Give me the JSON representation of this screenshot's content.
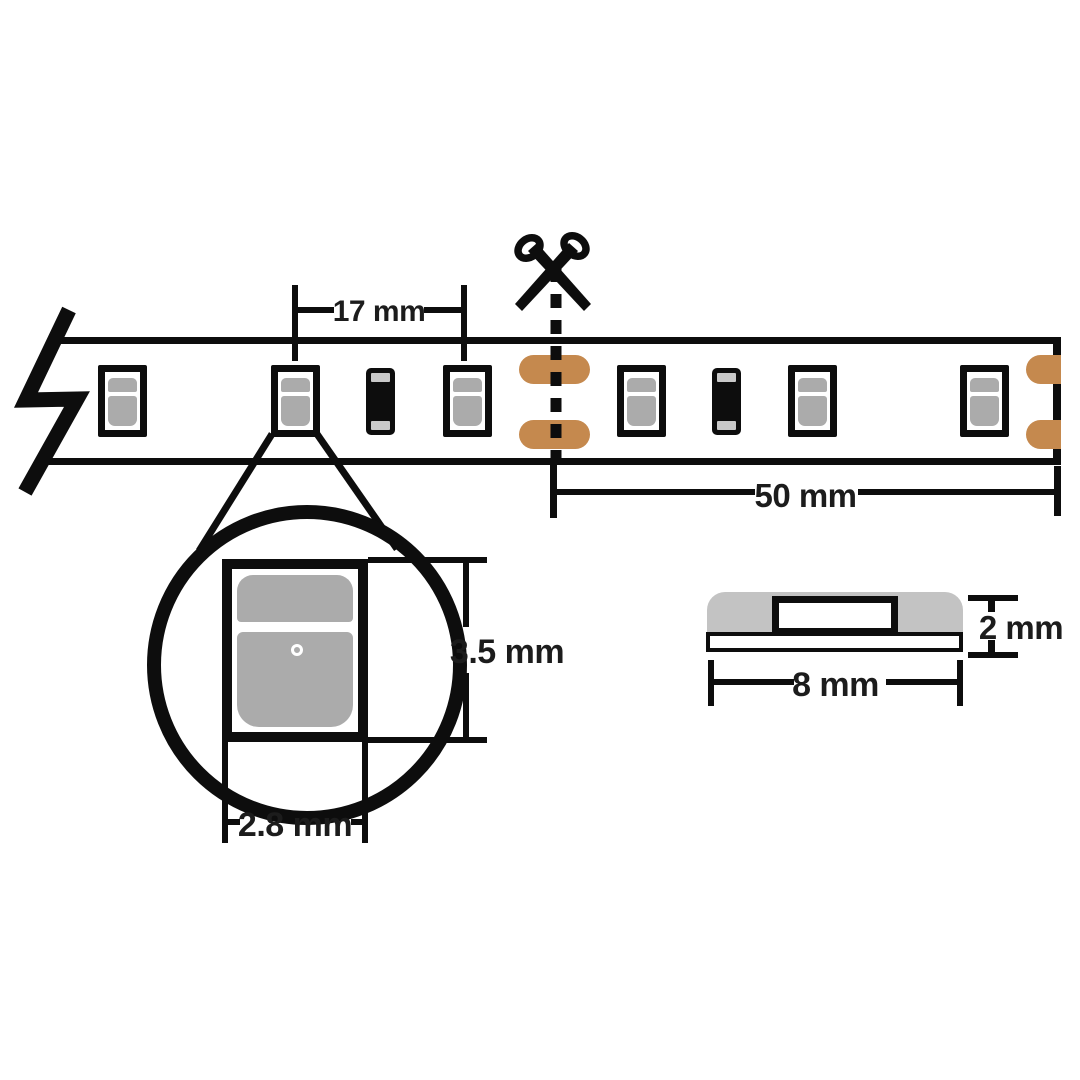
{
  "title": "LED strip cut-length and component dimensions diagram",
  "colors": {
    "line": "#0d0d0d",
    "text": "#1c1c1c",
    "led_gray": "#ababab",
    "terminal_gray": "#c9c9c9",
    "pad_copper": "#c5894e",
    "profile_gray": "#c3c3c3"
  },
  "dimensions": {
    "led_pitch": "17 mm",
    "cut_length": "50 mm",
    "led_height": "3.5 mm",
    "led_width": "2.8 mm",
    "strip_width": "8 mm",
    "strip_thickness": "2 mm"
  },
  "strip": {
    "components": [
      {
        "type": "led",
        "x": 98
      },
      {
        "type": "led",
        "x": 271
      },
      {
        "type": "resistor",
        "x": 366
      },
      {
        "type": "led",
        "x": 443
      },
      {
        "type": "pads",
        "x": 519
      },
      {
        "type": "led",
        "x": 617
      },
      {
        "type": "resistor",
        "x": 712
      },
      {
        "type": "led",
        "x": 788
      },
      {
        "type": "led",
        "x": 960
      },
      {
        "type": "pads-end",
        "x": 1026
      }
    ]
  },
  "icons": {
    "scissors": "scissors-icon",
    "break": "strip-break-icon",
    "cut_line": "dashed-cut-line"
  }
}
